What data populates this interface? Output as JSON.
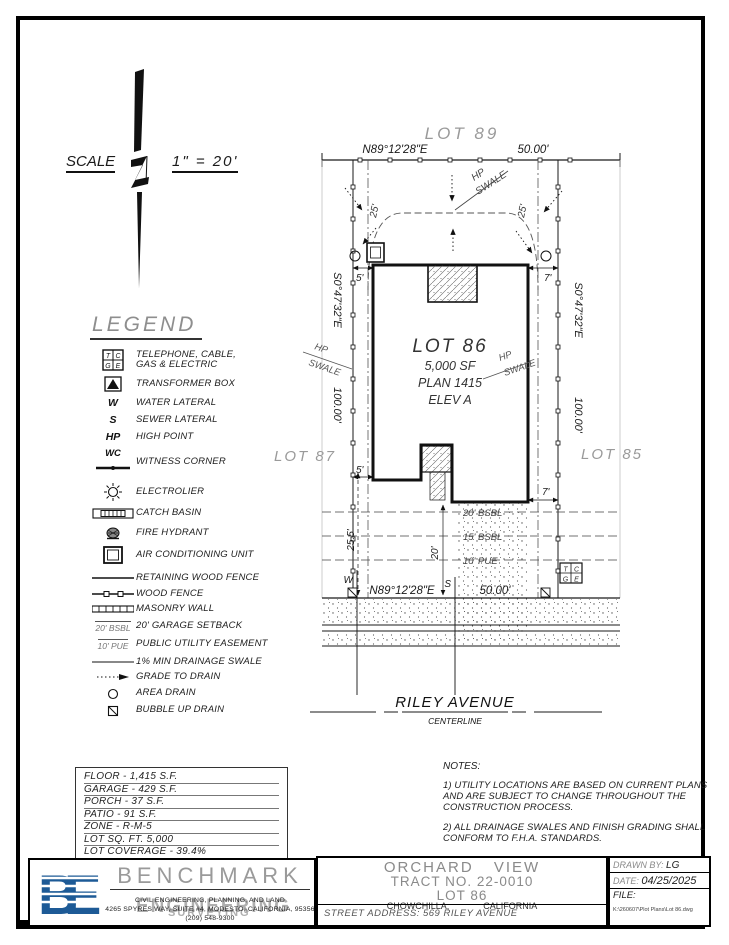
{
  "scale": {
    "label": "SCALE",
    "ratio": "1\" = 20'"
  },
  "legend": {
    "title": "LEGEND",
    "tcge": {
      "t": "T",
      "c": "C",
      "g": "G",
      "e": "E"
    },
    "items": [
      {
        "label": "TELEPHONE, CABLE,\nGAS & ELECTRIC"
      },
      {
        "label": "TRANSFORMER BOX"
      },
      {
        "sym": "W",
        "label": "WATER LATERAL"
      },
      {
        "sym": "S",
        "label": "SEWER LATERAL"
      },
      {
        "sym": "HP",
        "label": "HIGH POINT"
      },
      {
        "sym": "WC",
        "label": "WITNESS CORNER"
      },
      {
        "label": "ELECTROLIER"
      },
      {
        "label": "CATCH BASIN"
      },
      {
        "label": "FIRE HYDRANT"
      },
      {
        "label": "AIR CONDITIONING UNIT"
      },
      {
        "label": "RETAINING WOOD FENCE"
      },
      {
        "label": "WOOD FENCE"
      },
      {
        "label": "MASONRY WALL"
      },
      {
        "sym": "20' BSBL",
        "label": "20' GARAGE SETBACK"
      },
      {
        "sym": "10' PUE",
        "label": "PUBLIC UTILITY EASEMENT"
      },
      {
        "label": "1% MIN DRAINAGE SWALE"
      },
      {
        "label": "GRADE TO DRAIN"
      },
      {
        "label": "AREA DRAIN"
      },
      {
        "label": "BUBBLE UP DRAIN"
      }
    ]
  },
  "site": {
    "lot89": "LOT 89",
    "lot87": "LOT 87",
    "lot85": "LOT 85",
    "bearing_ew": "N89°12'28\"E",
    "dist_ew": "50.00'",
    "bearing_ns": "S0°47'32\"E",
    "dist_ns": "100.00'",
    "hp": "HP",
    "swale": "SWALE",
    "d25": "25'",
    "d5": "5'",
    "d7": "7'",
    "d255": "25.5'",
    "d20": "20'",
    "bsbl20": "20' BSBL",
    "bsbl15": "15' BSBL",
    "pue10": "10' PUE",
    "w": "W",
    "s": "S",
    "house": {
      "name": "LOT 86",
      "sf": "5,000 SF",
      "plan": "PLAN 1415",
      "elev": "ELEV A"
    },
    "street": {
      "name": "RILEY AVENUE",
      "center": "CENTERLINE"
    }
  },
  "stats": {
    "lines": [
      "FLOOR - 1,415 S.F.",
      "GARAGE - 429 S.F.",
      "PORCH - 37 S.F.",
      "PATIO - 91 S.F.",
      "ZONE - R-M-5",
      "LOT SQ. FT. 5,000",
      "LOT COVERAGE - 39.4%"
    ]
  },
  "notes": {
    "title": "NOTES:",
    "n1": "1) UTILITY LOCATIONS ARE BASED ON CURRENT PLANS AND ARE SUBJECT TO CHANGE THROUGHOUT THE CONSTRUCTION PROCESS.",
    "n2": "2) ALL DRAINAGE SWALES AND FINISH GRADING SHALL CONFORM TO F.H.A. STANDARDS."
  },
  "title_block": {
    "firm": {
      "initials": "BE",
      "name": "BENCHMARK",
      "overlay": "ENGINEERING",
      "overlay2": "SURVEYING",
      "services": "CIVIL ENGINEERING, PLANNING, AND LAND",
      "address": "4265 SPYRES WAY, SUITE #4, MODESTO, CALIFORNIA, 95356",
      "phone": "(209) 548-9300"
    },
    "project": {
      "l1": "ORCHARD VIEW",
      "l2": "TRACT NO. 22-0010",
      "l3": "LOT 86",
      "city": "CHOWCHILLA,",
      "state": "CALIFORNIA",
      "street": "STREET ADDRESS: 569 RILEY AVENUE"
    },
    "meta": {
      "drawn_label": "DRAWN BY:",
      "drawn": "LG",
      "date_label": "DATE:",
      "date": "04/25/2025",
      "file_label": "FILE:",
      "file_path": "K:\\260607\\Plot Plans\\Lot 86.dwg"
    }
  }
}
